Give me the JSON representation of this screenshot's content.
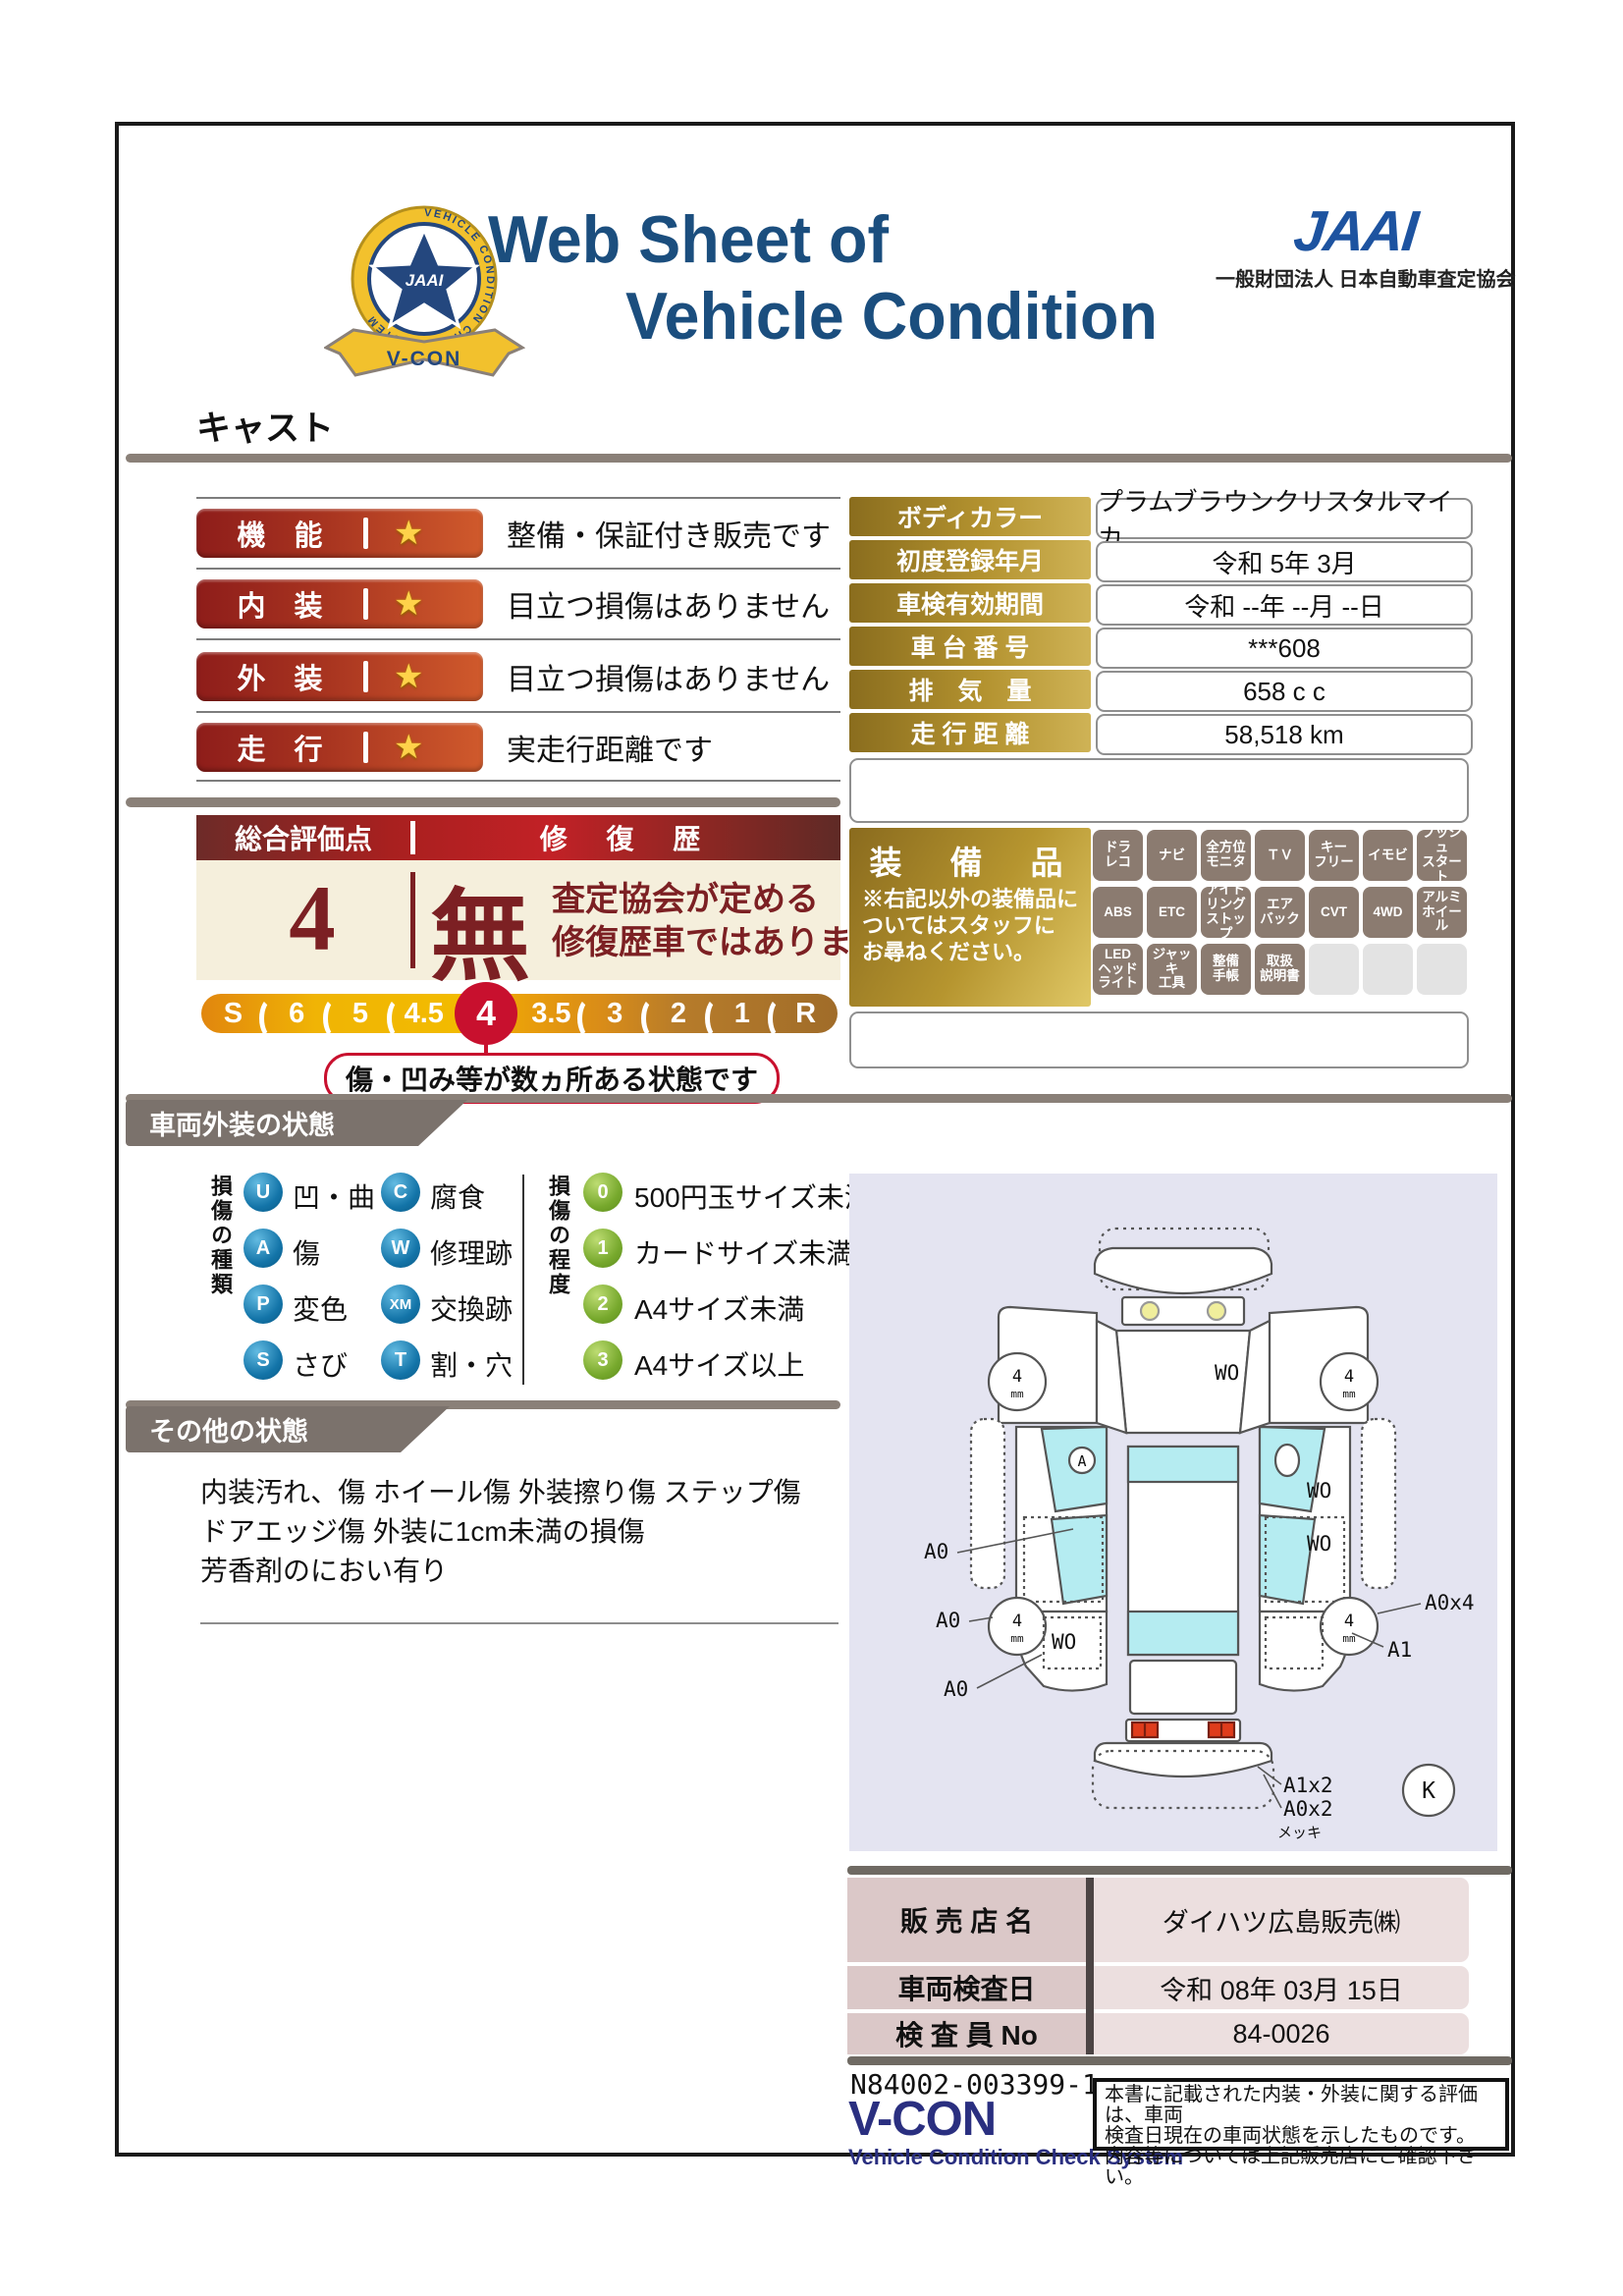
{
  "header": {
    "title_line1": "Web Sheet of",
    "title_line2": "Vehicle Condition",
    "jaai_word": "JAAI",
    "jaai_subtitle": "一般財団法人 日本自動車査定協会",
    "emblem": {
      "org": "JAAI",
      "ring_text": "VEHICLE CONDITION CHECK SYSTEM",
      "ribbon": "V-CON"
    }
  },
  "vehicle_name": "キャスト",
  "ratings": [
    {
      "label": "機　能",
      "star": "★",
      "desc": "整備・保証付き販売です"
    },
    {
      "label": "内　装",
      "star": "★",
      "desc": "目立つ損傷はありません"
    },
    {
      "label": "外　装",
      "star": "★",
      "desc": "目立つ損傷はありません"
    },
    {
      "label": "走　行",
      "star": "★",
      "desc": "実走行距離です"
    }
  ],
  "overall": {
    "header_left": "総合評価点",
    "header_right": "修 復 歴",
    "score": "4",
    "repair": "無",
    "repair_note": "査定協会が定める\n修復歴車ではありません",
    "scale": [
      "S",
      "6",
      "5",
      "4.5",
      "4",
      "3.5",
      "3",
      "2",
      "1",
      "R"
    ],
    "selected": "4",
    "callout": "傷・凹み等が数ヵ所ある状態です"
  },
  "info_table": {
    "rows": [
      {
        "label": "ボディカラー",
        "value": "プラムブラウンクリスタルマイカ"
      },
      {
        "label": "初度登録年月",
        "value": "令和 5年 3月"
      },
      {
        "label": "車検有効期間",
        "value": "令和 --年 --月 --日"
      },
      {
        "label": "車 台 番 号",
        "value": "***608"
      },
      {
        "label": "排　気　量",
        "value": "658 c c"
      },
      {
        "label": "走 行 距 離",
        "value": "58,518 km"
      }
    ]
  },
  "equipment": {
    "title": "装　備　品",
    "note": "※右記以外の装備品に\nついてはスタッフに\nお尋ねください。",
    "badges": [
      "ドラ\nレコ",
      "ナビ",
      "全方位\nモニタ",
      "ＴＶ",
      "キー\nフリー",
      "イモビ",
      "プッシュ\nスタート",
      "ABS",
      "ETC",
      "アイド\nリング\nストップ",
      "エア\nバック",
      "CVT",
      "4WD",
      "アルミ\nホイール",
      "LED\nヘッド\nライト",
      "ジャッキ\n工具",
      "整備\n手帳",
      "取扱\n説明書",
      "",
      "",
      ""
    ]
  },
  "exterior_section": {
    "title": "車両外装の状態",
    "type_label": "損傷の種類",
    "degree_label": "損傷の程度",
    "types": [
      {
        "code": "U",
        "label": "凹・曲"
      },
      {
        "code": "C",
        "label": "腐食"
      },
      {
        "code": "A",
        "label": "傷"
      },
      {
        "code": "W",
        "label": "修理跡"
      },
      {
        "code": "P",
        "label": "変色"
      },
      {
        "code": "XM",
        "label": "交換跡"
      },
      {
        "code": "S",
        "label": "さび"
      },
      {
        "code": "T",
        "label": "割・穴"
      }
    ],
    "degrees": [
      {
        "code": "0",
        "label": "500円玉サイズ未満"
      },
      {
        "code": "1",
        "label": "カードサイズ未満"
      },
      {
        "code": "2",
        "label": "A4サイズ未満"
      },
      {
        "code": "3",
        "label": "A4サイズ以上"
      }
    ]
  },
  "other_section": {
    "title": "その他の状態",
    "text": "内装汚れ、傷 ホイール傷 外装擦り傷 ステップ傷\nドアエッジ傷 外装に1cm未満の損傷\n芳香剤のにおい有り"
  },
  "diagram": {
    "windshield": "WO",
    "door_a": "A",
    "wo_right_1": "WO",
    "wo_right_2": "WO",
    "wo_left": "WO",
    "a0_1": "A0",
    "a0_2": "A0",
    "a0_3": "A0",
    "a0x4": "A0x4",
    "a1": "A1",
    "a1x2": "A1x2",
    "a0x2": "A0x2",
    "mekki": "メッキ",
    "k": "K",
    "wheel": "4",
    "wheel_unit": "mm"
  },
  "dealer": {
    "rows": [
      {
        "label": "販 売 店 名",
        "value": "ダイハツ広島販売㈱"
      },
      {
        "label": "車両検査日",
        "value": "令和 08年 03月 15日"
      },
      {
        "label": "検 査 員 No",
        "value": "84-0026"
      }
    ]
  },
  "footer": {
    "doc_number": "N84002-003399-1",
    "vcon": "V-CON",
    "vcon_sub": "Vehicle Condition Check System",
    "note": "本書に記載された内装・外装に関する評価は、車両\n検査日現在の車両状態を示したものです。\n内容等については上記販売店にご確認下さい。"
  },
  "colors": {
    "title_navy": "#1b4e7e",
    "pill_red": "#8e1d1a",
    "gold": "#b3922f",
    "selected_red": "#c8102e",
    "banner_gray": "#7b726c"
  }
}
